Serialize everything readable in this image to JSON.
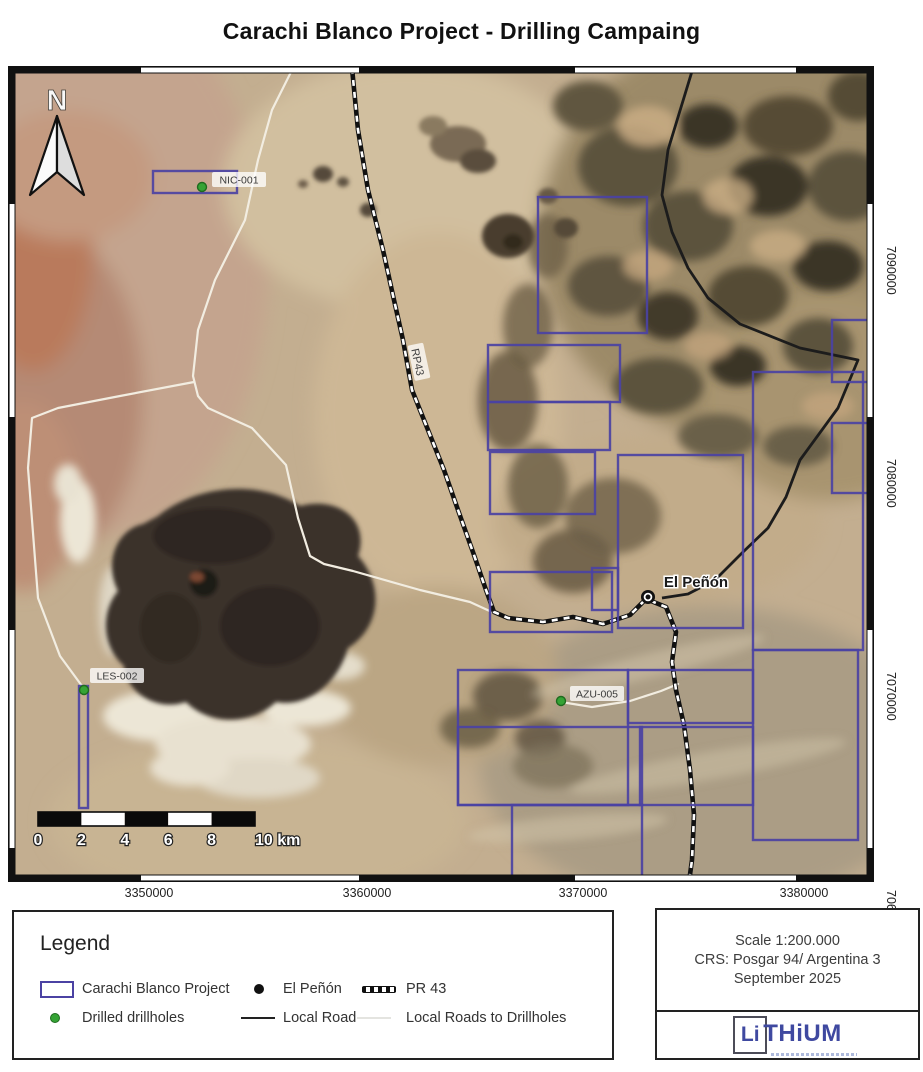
{
  "title": "Carachi Blanco Project - Drilling Campaing",
  "map": {
    "north_label": "N",
    "claim_color": "#4b42a3",
    "claims": [
      [
        145,
        105,
        84,
        22
      ],
      [
        71,
        620,
        9,
        122
      ],
      [
        530,
        131,
        109,
        136
      ],
      [
        480,
        279,
        132,
        57
      ],
      [
        480,
        336,
        122,
        48
      ],
      [
        482,
        386,
        105,
        62
      ],
      [
        482,
        506,
        122,
        60
      ],
      [
        610,
        389,
        125,
        173
      ],
      [
        584,
        502,
        26,
        42
      ],
      [
        745,
        306,
        110,
        278
      ],
      [
        824,
        254,
        42,
        62
      ],
      [
        824,
        357,
        42,
        70
      ],
      [
        450,
        604,
        170,
        135
      ],
      [
        450,
        661,
        184,
        78
      ],
      [
        620,
        604,
        125,
        53
      ],
      [
        632,
        661,
        113,
        78
      ],
      [
        745,
        584,
        105,
        190
      ],
      [
        504,
        739,
        130,
        77
      ]
    ],
    "drillholes": [
      {
        "id": "NIC-001",
        "dot": [
          194,
          121
        ],
        "chip": [
          204,
          106
        ]
      },
      {
        "id": "LES-002",
        "dot": [
          76,
          624
        ],
        "chip": [
          82,
          602
        ]
      },
      {
        "id": "AZU-005",
        "dot": [
          553,
          635
        ],
        "chip": [
          562,
          620
        ]
      }
    ],
    "town": {
      "name": "El Peñón",
      "dot": [
        640,
        531
      ],
      "label": [
        688,
        521
      ]
    },
    "road_label": {
      "text": "RP43",
      "x": 410,
      "y": 296,
      "rotation": 78
    },
    "roads_white": [
      [
        [
          285,
          2
        ],
        [
          264,
          44
        ],
        [
          250,
          94
        ],
        [
          237,
          154
        ],
        [
          207,
          214
        ],
        [
          190,
          264
        ],
        [
          185,
          310
        ],
        [
          190,
          330
        ],
        [
          200,
          342
        ],
        [
          244,
          362
        ],
        [
          278,
          399
        ],
        [
          290,
          452
        ],
        [
          302,
          490
        ],
        [
          316,
          498
        ],
        [
          345,
          505
        ],
        [
          412,
          524
        ],
        [
          462,
          536
        ],
        [
          486,
          547
        ]
      ],
      [
        [
          186,
          316
        ],
        [
          112,
          330
        ],
        [
          50,
          342
        ],
        [
          24,
          352
        ],
        [
          20,
          402
        ],
        [
          30,
          532
        ],
        [
          52,
          590
        ],
        [
          74,
          620
        ],
        [
          76,
          624
        ]
      ],
      [
        [
          553,
          636
        ],
        [
          584,
          641
        ],
        [
          622,
          635
        ],
        [
          653,
          625
        ],
        [
          670,
          618
        ]
      ]
    ],
    "roads_black": [
      [
        [
          685,
          2
        ],
        [
          660,
          84
        ],
        [
          654,
          129
        ],
        [
          664,
          166
        ],
        [
          680,
          202
        ],
        [
          700,
          232
        ],
        [
          732,
          258
        ],
        [
          792,
          282
        ],
        [
          850,
          294
        ],
        [
          830,
          342
        ],
        [
          792,
          394
        ],
        [
          778,
          431
        ],
        [
          760,
          462
        ],
        [
          734,
          487
        ],
        [
          707,
          514
        ],
        [
          680,
          528
        ],
        [
          654,
          532
        ]
      ]
    ],
    "road_dashed": [
      [
        [
          344,
          2
        ],
        [
          350,
          64
        ],
        [
          360,
          124
        ],
        [
          375,
          184
        ],
        [
          386,
          234
        ],
        [
          395,
          274
        ],
        [
          404,
          324
        ],
        [
          420,
          364
        ],
        [
          436,
          404
        ],
        [
          450,
          444
        ],
        [
          466,
          489
        ],
        [
          478,
          524
        ],
        [
          486,
          546
        ],
        [
          500,
          552
        ],
        [
          535,
          556
        ],
        [
          565,
          551
        ],
        [
          595,
          558
        ],
        [
          622,
          549
        ],
        [
          638,
          533
        ],
        [
          658,
          541
        ],
        [
          668,
          566
        ],
        [
          664,
          596
        ],
        [
          668,
          624
        ],
        [
          676,
          659
        ],
        [
          682,
          704
        ],
        [
          686,
          749
        ],
        [
          684,
          794
        ],
        [
          681,
          816
        ]
      ]
    ],
    "scale_bar": {
      "labels": [
        "0",
        "2",
        "4",
        "6",
        "8",
        "10 km"
      ],
      "x0": 30,
      "x1": 247,
      "y": 746,
      "h": 14
    },
    "x_axis": [
      {
        "label": "3350000",
        "x": 141
      },
      {
        "label": "3360000",
        "x": 359
      },
      {
        "label": "3370000",
        "x": 575
      },
      {
        "label": "3380000",
        "x": 796
      }
    ],
    "y_axis": [
      {
        "label": "7090000",
        "y": 204
      },
      {
        "label": "7080000",
        "y": 417
      },
      {
        "label": "7070000",
        "y": 630
      },
      {
        "label": "7060000",
        "y": 848
      }
    ]
  },
  "legend": {
    "title": "Legend",
    "row1": [
      {
        "label": "Carachi Blanco Project"
      },
      {
        "label": "El Peñón"
      },
      {
        "label": "PR 43"
      }
    ],
    "row2": [
      {
        "label": "Drilled drillholes"
      },
      {
        "label": "Local Road"
      },
      {
        "label": "Local Roads to Drillholes"
      }
    ]
  },
  "info_box": {
    "scale": "Scale 1:200.000",
    "crs": "CRS: Posgar 94/ Argentina 3",
    "date": "September 2025"
  },
  "logo": {
    "box_text": "Li",
    "rest": "THiUM"
  }
}
